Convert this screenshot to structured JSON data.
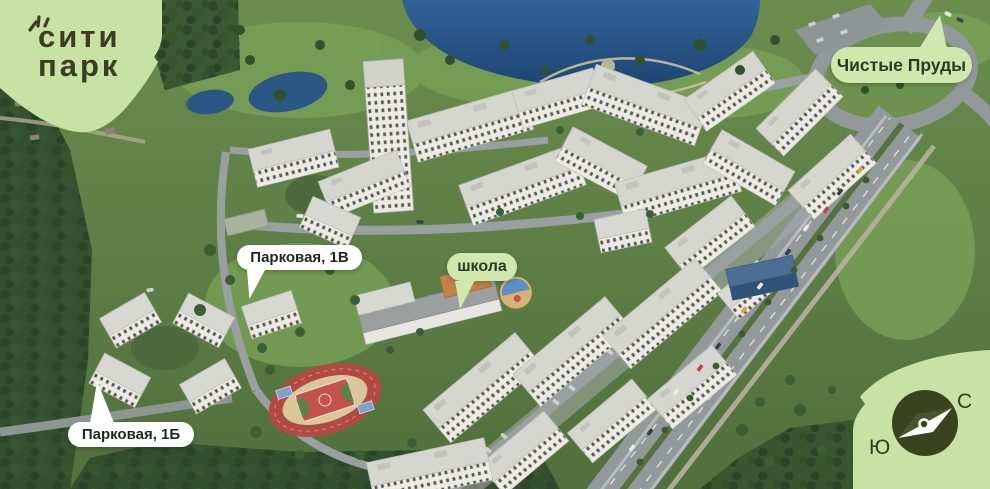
{
  "brand": {
    "line1": "сити",
    "line2": "парк"
  },
  "map_labels": {
    "chistye_prudy": {
      "text": "Чистые Пруды"
    },
    "parkovaya_1v": {
      "text": "Парковая, 1В"
    },
    "shkola": {
      "text": "школа"
    },
    "parkovaya_1b": {
      "text": "Парковая, 1Б"
    }
  },
  "compass": {
    "north_label": "С",
    "south_label": "Ю"
  },
  "icons": {
    "logo_rays": "sprout-rays-icon",
    "compass_needle": "compass-needle-icon"
  },
  "colors": {
    "panel_green": "#c8e1a5",
    "badge_green": "#cfe8ad",
    "badge_white": "#ffffff",
    "logo_text": "#3c3c20",
    "label_text_dark": "#1d2820",
    "badge_green_text": "#2c3a24",
    "compass_dark": "#39431f",
    "grass": "#5c7d44",
    "forest": "#2f4a2b",
    "water": "#2b5c8e",
    "road": "#93989b",
    "track_red": "#b14a42",
    "building_white": "#ecebe5"
  }
}
